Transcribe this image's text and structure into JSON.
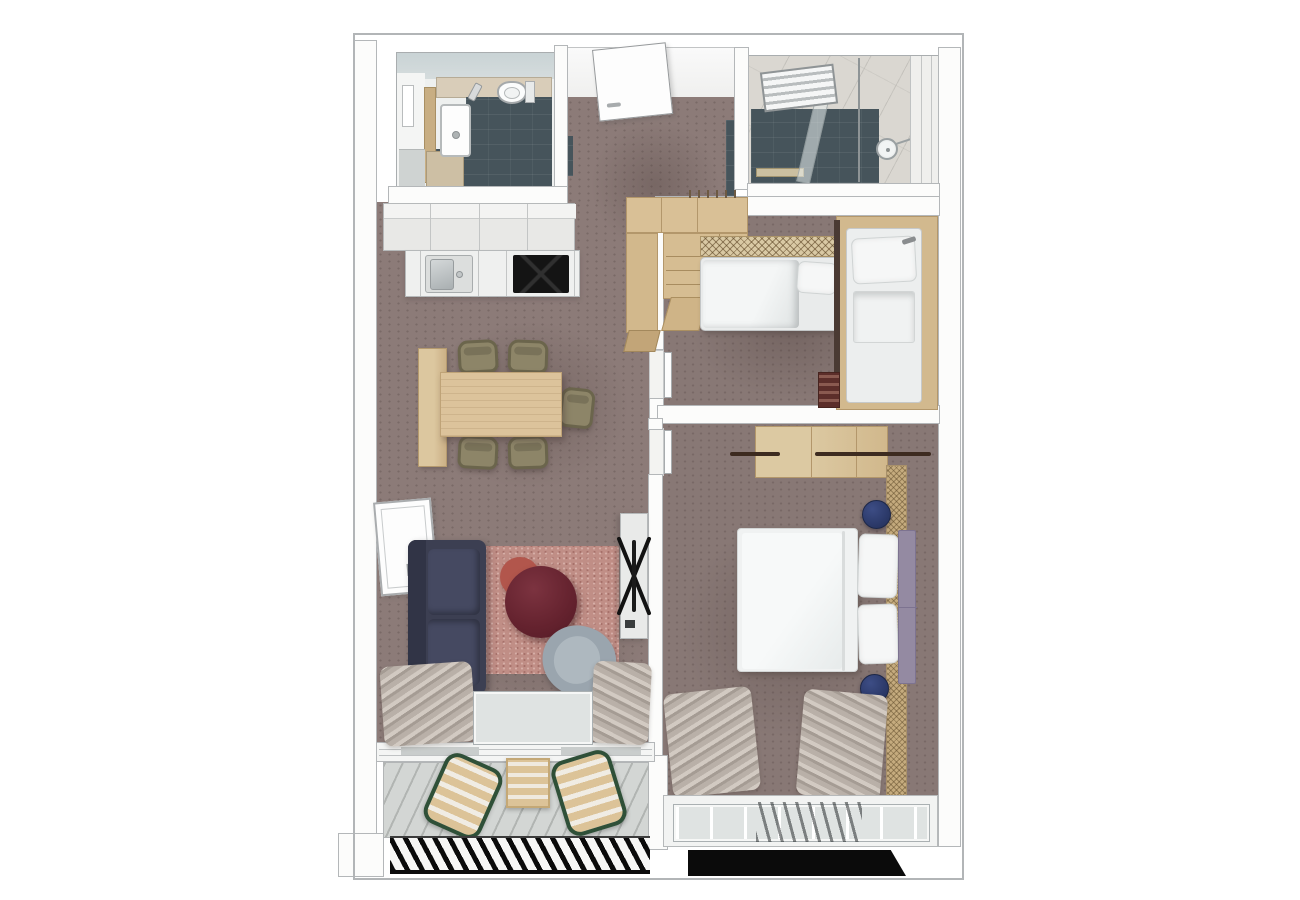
{
  "document": {
    "kind": "apartment-floor-plan",
    "view": "top-down 3d render",
    "background": "#ffffff",
    "visible_text": "none"
  },
  "palette": {
    "carpet_mauve": "#8c7b78",
    "wall_white": "#fcfcfb",
    "wall_line_grey": "#b4b7b9",
    "wood_light": "#dcc39b",
    "wood_mid": "#c9ad80",
    "slate_tile_teal": "#46545b",
    "pale_aqua_wall": "#c9d3d5",
    "shower_tile_grey": "#dad7d1",
    "kitchen_counter": "#eff0ef",
    "cooktop_black": "#141414",
    "sofa_navy": "#3c3f52",
    "rug_rose": "#c08e86",
    "coffee_table_maroon": "#64222e",
    "side_table_terracotta": "#b2564c",
    "armchair_grey": "#a2adb5",
    "dining_chair_olive": "#8d8568",
    "pouf_navy": "#2c3a6a",
    "headboard_purple": "#948aa2",
    "lounger_frame_green": "#2f5038",
    "balcony_deck_grey": "#d3d6d4",
    "railing_black": "#0b0b0b",
    "bed_linen_white": "#f0f2f2",
    "mat_rattan_tan": "#c5ab7e"
  },
  "rooms": [
    {
      "id": "bathroom",
      "name": "bathroom-wc",
      "furniture": [
        "washbasin",
        "faucet",
        "toilet",
        "vanity-cabinet",
        "mirror",
        "slate-tile-floor"
      ]
    },
    {
      "id": "entry",
      "name": "entry-hall",
      "furniture": [
        "entrance-door",
        "hall-wardrobe",
        "coat-hooks"
      ]
    },
    {
      "id": "shower_room",
      "name": "shower-room",
      "furniture": [
        "towel-radiator",
        "rain-shower-head",
        "shower-rail",
        "glass-partition",
        "slate-tile-floor"
      ]
    },
    {
      "id": "kitchen",
      "name": "kitchen",
      "furniture": [
        "tall-cabinet-row",
        "counter-run",
        "inset-sink",
        "induction-cooktop"
      ]
    },
    {
      "id": "dining",
      "name": "dining-area",
      "furniture": [
        "dining-table",
        "dining-bench",
        "dining-chair-1",
        "dining-chair-2",
        "dining-chair-3",
        "dining-chair-4",
        "dining-chair-5"
      ]
    },
    {
      "id": "living",
      "name": "living-area",
      "furniture": [
        "sofa",
        "rose-rug",
        "coffee-table-maroon",
        "side-table-terracotta",
        "swivel-armchair",
        "tv-sideboard",
        "tv-on-stand",
        "open-window",
        "curtains",
        "sliding-glass-door"
      ]
    },
    {
      "id": "kids_room",
      "name": "kids-bunk-room",
      "furniture": [
        "closet-shelves",
        "single-bed-horizontal",
        "mesh-headboard",
        "single-bed-vertical",
        "bunk-ladder",
        "bed-frame-wood"
      ]
    },
    {
      "id": "master_bedroom",
      "name": "master-bedroom",
      "furniture": [
        "double-bed",
        "pillow-pair",
        "headboard-purple",
        "open-wardrobe-with-rails",
        "pouf-1",
        "pouf-2",
        "rattan-floor-mat",
        "curtains",
        "window-front",
        "door-leaf"
      ]
    },
    {
      "id": "balcony",
      "name": "balcony",
      "furniture": [
        "lounger-1",
        "lounger-2",
        "slat-table",
        "deck-boards",
        "black-railing"
      ]
    }
  ]
}
